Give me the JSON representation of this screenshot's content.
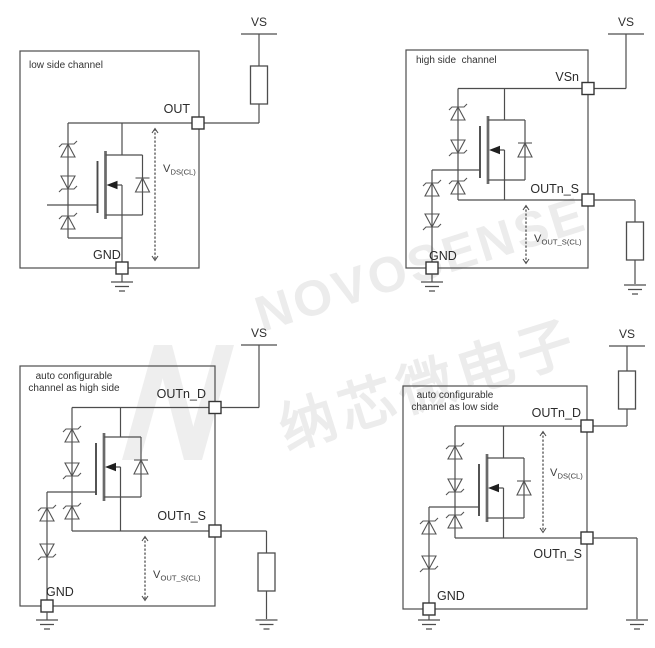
{
  "watermark": {
    "logo_letter": "N",
    "latin": "NOVOSENSE",
    "chinese": "纳芯微电子"
  },
  "diagrams": {
    "low_side": {
      "title": "low side channel",
      "supply": "VS",
      "pads": {
        "out": "OUT",
        "gnd": "GND"
      },
      "voltage": {
        "main": "V",
        "sub": "DS(CL)"
      }
    },
    "high_side": {
      "title": "high side  channel",
      "supply": "VS",
      "pads": {
        "vsn": "VSn",
        "out_s": "OUTn_S",
        "gnd": "GND"
      },
      "voltage": {
        "main": "V",
        "sub": "OUT_S(CL)"
      }
    },
    "auto_high_side": {
      "title_line1": "auto configurable",
      "title_line2": "channel as high side",
      "supply": "VS",
      "pads": {
        "out_d": "OUTn_D",
        "out_s": "OUTn_S",
        "gnd": "GND"
      },
      "voltage": {
        "main": "V",
        "sub": "OUT_S(CL)"
      }
    },
    "auto_low_side": {
      "title_line1": "auto configurable",
      "title_line2": "channel as low side",
      "supply": "VS",
      "pads": {
        "out_d": "OUTn_D",
        "out_s": "OUTn_S",
        "gnd": "GND"
      },
      "voltage": {
        "main": "V",
        "sub": "DS(CL)"
      }
    }
  },
  "colors": {
    "line": "#4d4d4d",
    "text": "#2b2b2b",
    "watermark": "#ececec",
    "background": "#ffffff"
  }
}
